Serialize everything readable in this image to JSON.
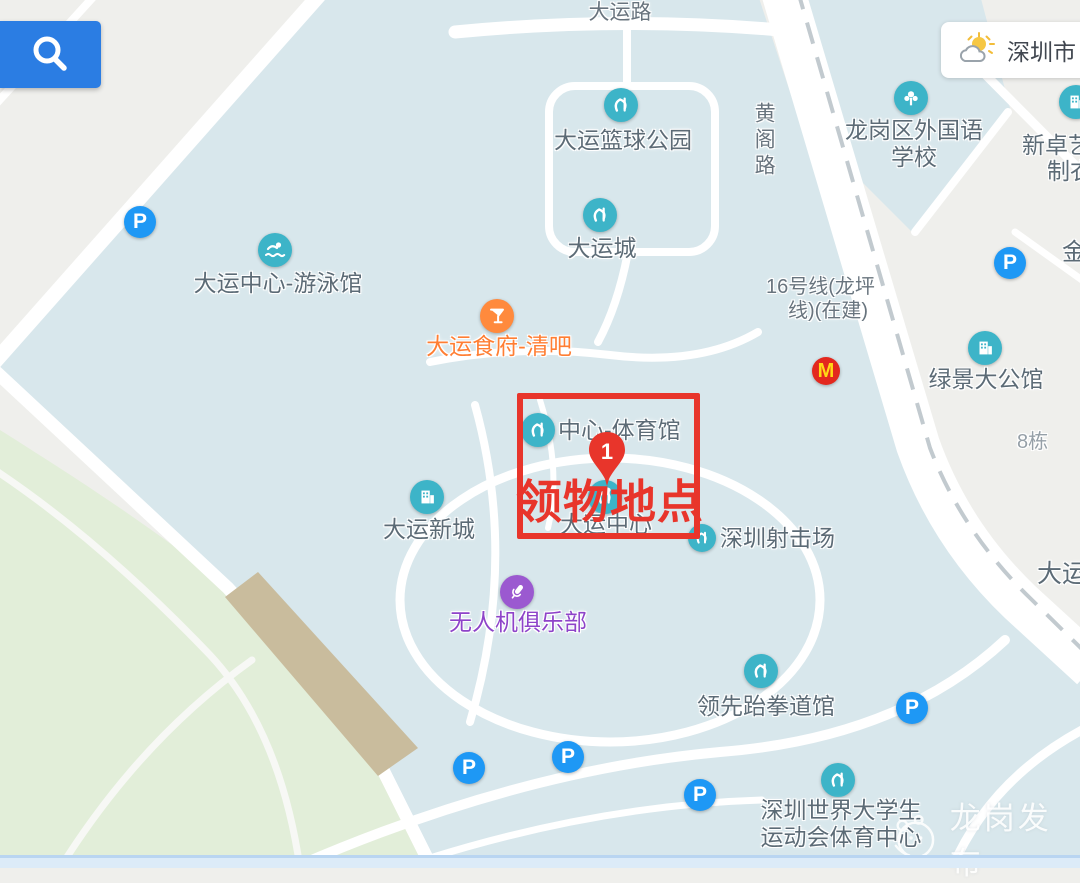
{
  "weather": {
    "city": "深圳市"
  },
  "roads": {
    "top_road": "大运路",
    "right_road": "黄阁路",
    "metro_line1": "16号线(龙坪",
    "metro_line2": "线)(在建)"
  },
  "annotation": {
    "pin_number": "1",
    "label": "领物地点"
  },
  "parking": {
    "label": "P"
  },
  "mcdonalds": {
    "label": "M"
  },
  "watermark": {
    "text": "龙岗发布"
  },
  "pois": [
    {
      "label": "大运篮球公园"
    },
    {
      "label": "大运城"
    },
    {
      "line1": "龙岗区外国语",
      "line2": "学校"
    },
    {
      "line1": "新卓艺",
      "line2": "制衣"
    },
    {
      "label": "大运中心-游泳馆"
    },
    {
      "label": "大运食府-清吧"
    },
    {
      "label": "绿景大公馆"
    },
    {
      "label": "8栋"
    },
    {
      "label": "金"
    },
    {
      "label": "中心-体育馆"
    },
    {
      "label": "大运中心"
    },
    {
      "label": "深圳射击场"
    },
    {
      "label": "大运新城"
    },
    {
      "label": "无人机俱乐部"
    },
    {
      "label": "领先跆拳道馆"
    },
    {
      "line1": "深圳世界大学生",
      "line2": "运动会体育中心"
    },
    {
      "label": "大运"
    }
  ],
  "colors": {
    "campus_blue": "#d8e7ec",
    "park_green": "#e2eed9",
    "bridge_tan": "#c9bc9d",
    "poi_teal": "#3db4c8",
    "parking_blue": "#1e98f5",
    "food_orange": "#ff8a3d",
    "drone_purple": "#9b59d0",
    "annotation_red": "#e8352b",
    "search_blue": "#2b7de3"
  }
}
